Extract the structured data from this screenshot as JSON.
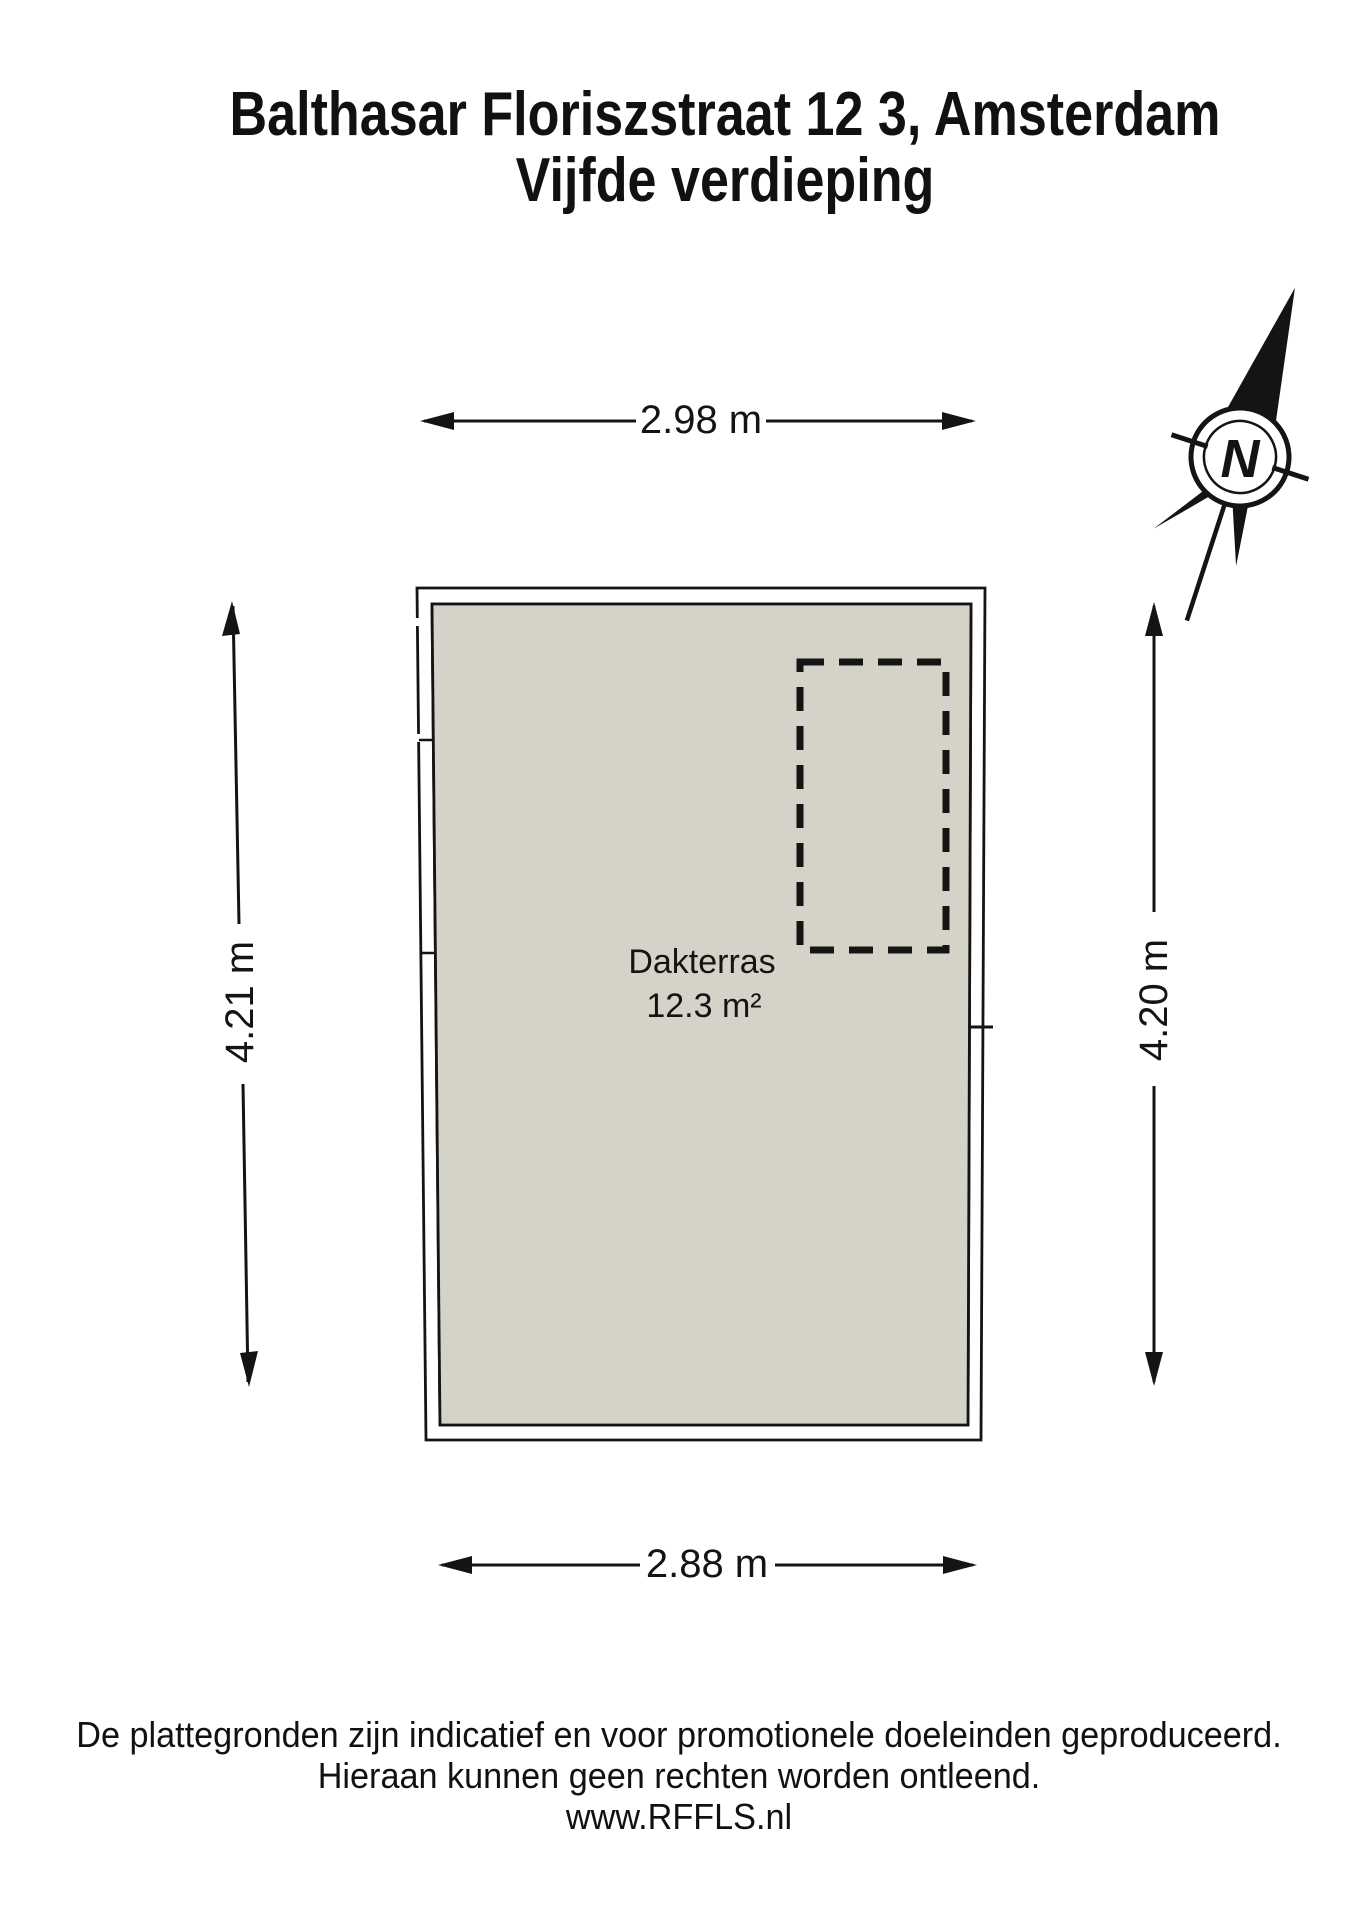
{
  "title": {
    "line1": "Balthasar Floriszstraat 12 3, Amsterdam",
    "line2": "Vijfde verdieping"
  },
  "floor_plan": {
    "room": {
      "name": "Dakterras",
      "area": "12.3 m²"
    },
    "dimensions": {
      "top": "2.98 m",
      "bottom": "2.88 m",
      "left": "4.21 m",
      "right": "4.20 m"
    },
    "compass": {
      "label": "N"
    }
  },
  "footer": {
    "line1": "De plattegronden zijn indicatief en voor promotionele doeleinden geproduceerd.",
    "line2": "Hieraan kunnen geen rechten worden ontleend.",
    "line3": "www.RFFLS.nl"
  },
  "colors": {
    "floor_fill": "#d5d3c8",
    "line": "#141414",
    "wall_fill": "#ffffff",
    "background": "#ffffff"
  }
}
